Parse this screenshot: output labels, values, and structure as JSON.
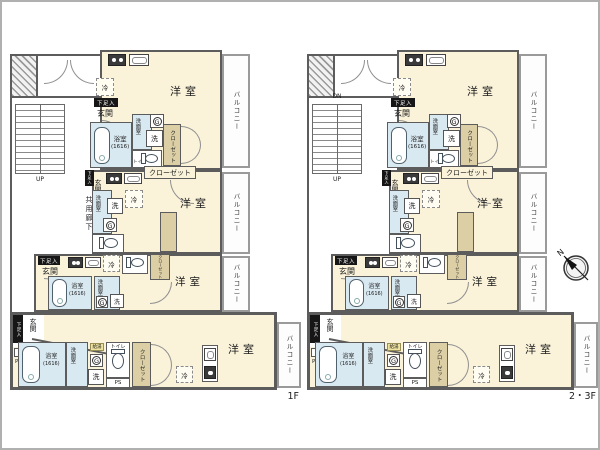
{
  "palette": {
    "wall": "#5c5c5c",
    "room_cream": "#faf3da",
    "wet_blue": "#d9e9f1",
    "closet_tan": "#dccfa5",
    "heater_yellow": "#efe3a0",
    "tag_black": "#161616"
  },
  "floors": [
    {
      "floor_label": "1F",
      "stair_top_label": "",
      "stair_bottom_label": "UP",
      "corridor_label": "共用廊下",
      "has_compass": false
    },
    {
      "floor_label": "2・3F",
      "stair_top_label": "DN",
      "stair_bottom_label": "UP",
      "corridor_label": "",
      "has_compass": true
    }
  ],
  "labels": {
    "western_room": "洋室",
    "balcony": "バルコニー",
    "entrance": "玄関",
    "bath": "浴室",
    "bath_size": "(1616)",
    "washroom": "洗面室",
    "washing_machine": "洗",
    "refrigerator": "冷",
    "toilet": "トイレ",
    "closet": "クローゼット",
    "shoe_cabinet": "下足入",
    "pipe_space": "PS",
    "water_heater_g": "G",
    "water_heater_small": "給湯",
    "compass_north": "N"
  }
}
